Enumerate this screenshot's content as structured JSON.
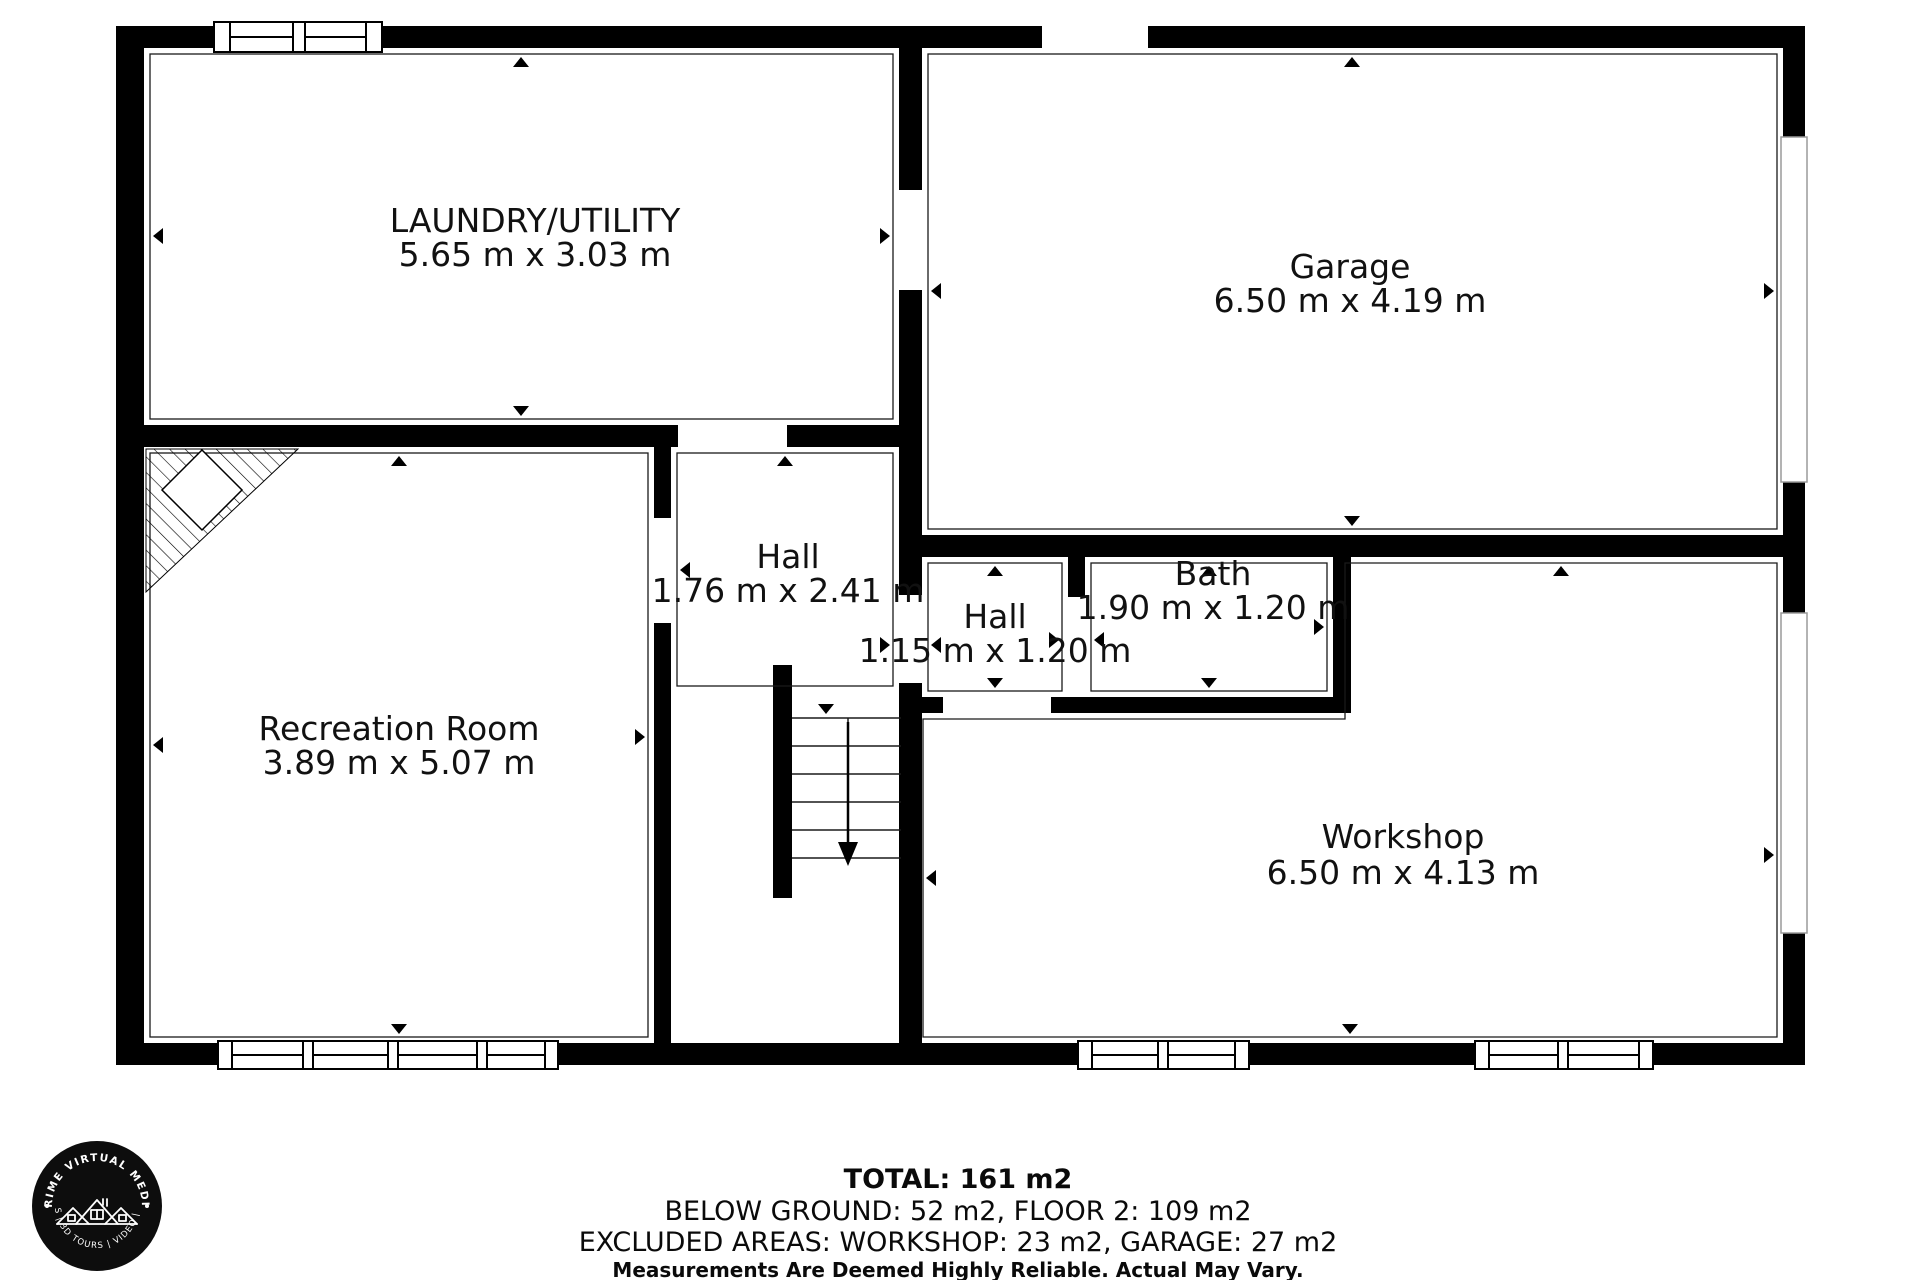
{
  "plan": {
    "rooms": [
      {
        "id": "laundry",
        "name": "LAUNDRY/UTILITY",
        "dims": "5.65 m x 3.03 m"
      },
      {
        "id": "garage",
        "name": "Garage",
        "dims": "6.50 m x 4.19 m"
      },
      {
        "id": "hall-upper",
        "name": "Hall",
        "dims": "1.76 m x 2.41 m"
      },
      {
        "id": "hall-lower",
        "name": "Hall",
        "dims": "1.15 m x 1.20 m"
      },
      {
        "id": "bath",
        "name": "Bath",
        "dims": "1.90 m x 1.20 m"
      },
      {
        "id": "recreation",
        "name": "Recreation Room",
        "dims": "3.89 m x 5.07 m"
      },
      {
        "id": "workshop",
        "name": "Workshop",
        "dims": "6.50 m x 4.13 m"
      }
    ],
    "features": [
      "stairs-down-arrow",
      "chimney-hatch-corner",
      "window-symbols",
      "door-opening-markers"
    ]
  },
  "summary": {
    "total": "TOTAL: 161 m2",
    "breakdown": "BELOW GROUND: 52 m2, FLOOR 2: 109 m2",
    "excluded": "EXCLUDED AREAS: WORKSHOP: 23 m2, GARAGE: 27 m2",
    "disclaimer": "Measurements Are Deemed Highly Reliable. Actual May Vary."
  },
  "logo": {
    "top_text": "PRIME VIRTUAL MEDIA",
    "bottom_text": "PHOTOS | 3D TOURS | VIDEO | DRONE",
    "icon": "house-roofs-icon",
    "shape": "black-circle-badge"
  },
  "colors": {
    "background": "#ffffff",
    "walls": "#000000",
    "text": "#111111",
    "slot_window_border": "#9a9a9a"
  }
}
